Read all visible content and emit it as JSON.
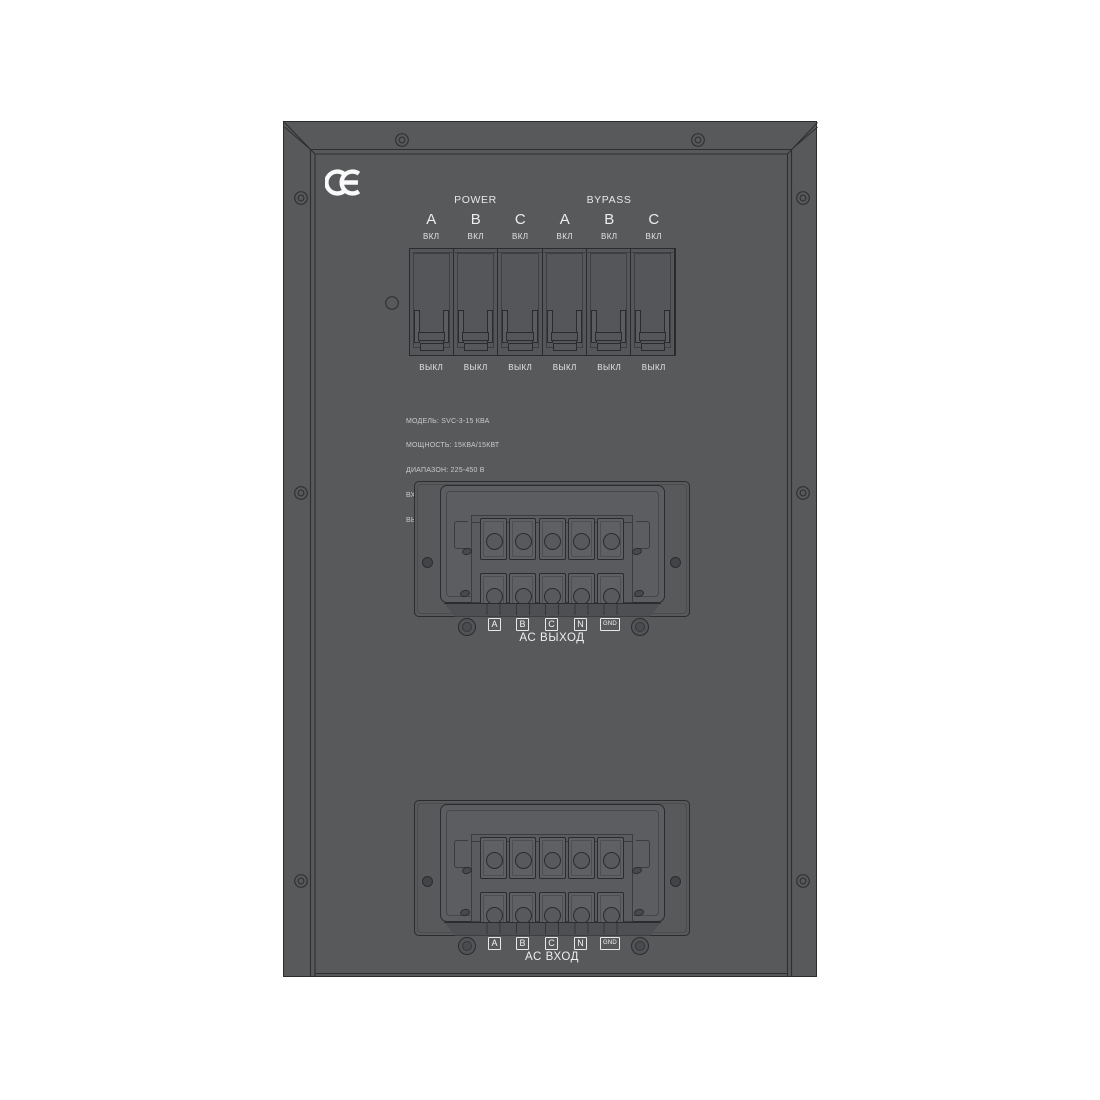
{
  "ce_mark": "CE",
  "breaker_panel": {
    "groups": [
      {
        "label": "POWER"
      },
      {
        "label": "BYPASS"
      }
    ],
    "cells": [
      {
        "phase": "A",
        "on_label": "ВКЛ",
        "off_label": "ВЫКЛ"
      },
      {
        "phase": "B",
        "on_label": "ВКЛ",
        "off_label": "ВЫКЛ"
      },
      {
        "phase": "C",
        "on_label": "ВКЛ",
        "off_label": "ВЫКЛ"
      },
      {
        "phase": "A",
        "on_label": "ВКЛ",
        "off_label": "ВЫКЛ"
      },
      {
        "phase": "B",
        "on_label": "ВКЛ",
        "off_label": "ВЫКЛ"
      },
      {
        "phase": "C",
        "on_label": "ВКЛ",
        "off_label": "ВЫКЛ"
      }
    ]
  },
  "specs": {
    "lines": [
      "МОДЕЛЬ: SVC-3-15 КВА",
      "МОЩНОСТЬ: 15КВА/15КВТ",
      "ДИАПАЗОН: 225-450 В",
      "ВХ.ЧАСТОТА: 50ГЦ/60ГЦ",
      "ВЫХ.НАПРЯЖЕНИЕ: 380В+/-3%"
    ]
  },
  "terminal_blocks": [
    {
      "id": "ac-output",
      "caption": "АС ВЫХОД",
      "labels": [
        "A",
        "B",
        "C",
        "N",
        "GND"
      ]
    },
    {
      "id": "ac-input",
      "caption": "АС ВХОД",
      "labels": [
        "A",
        "B",
        "C",
        "N",
        "GND"
      ]
    }
  ],
  "colors": {
    "background": "#ffffff",
    "panel": "#58595b",
    "outline": "#2b2c2e",
    "text": "#ecedee"
  }
}
